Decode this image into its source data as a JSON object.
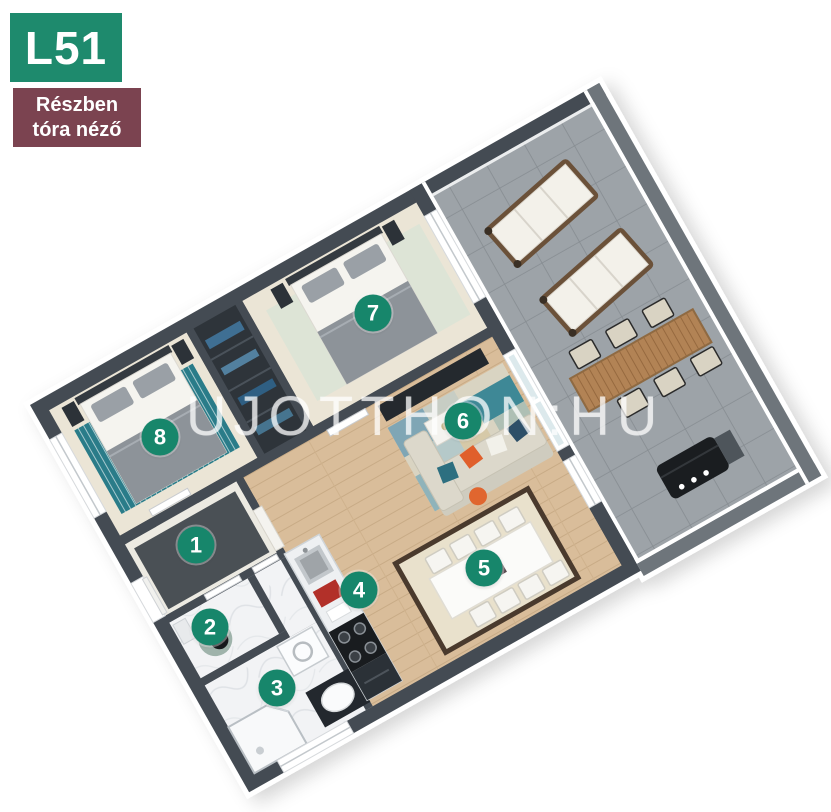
{
  "badge": {
    "unit": "L51",
    "subtitle_line1": "Részben",
    "subtitle_line2": "tóra néző"
  },
  "watermark": "UJOTTHON:HU",
  "markers": [
    {
      "number": "1"
    },
    {
      "number": "2"
    },
    {
      "number": "3"
    },
    {
      "number": "4"
    },
    {
      "number": "5"
    },
    {
      "number": "6"
    },
    {
      "number": "7"
    },
    {
      "number": "8"
    }
  ],
  "colors": {
    "accent_green": "#1E8A6D",
    "marker_green": "#17866B",
    "badge_maroon": "#7B4350",
    "wall_gray": "#444B53",
    "wood_floor": "#D9BD9A",
    "terrace_tile": "#9DA3A8",
    "teal_rug": "#2A7C89"
  }
}
